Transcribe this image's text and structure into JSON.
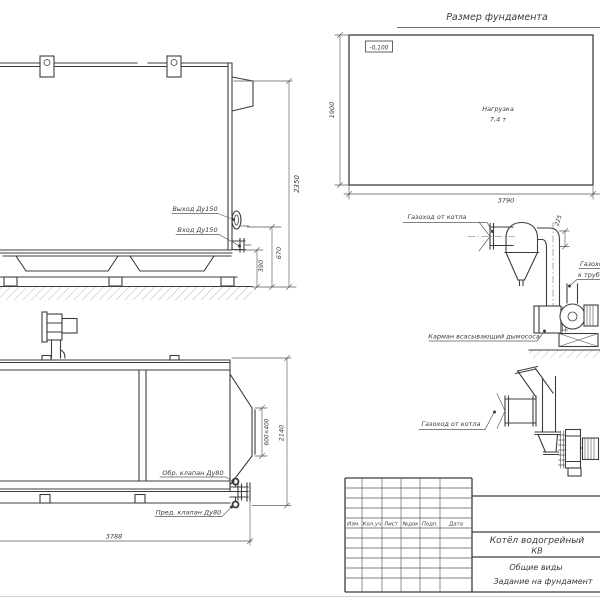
{
  "colors": {
    "line": "#3d3d3d",
    "thin_line": "#5a5a5a",
    "text": "#3a3a3a",
    "sheet": "#ffffff"
  },
  "side_view": {
    "label_outlet": "Выход Ду150",
    "label_inlet": "Вход Ду150",
    "dim_total_height": "2350",
    "dim_inlet_height": "670",
    "dim_frame_height": "390"
  },
  "foundation_plan": {
    "title": "Размер фундамента",
    "elevation_mark": "-0,100",
    "load_line1": "Нагрузка",
    "load_line2": "7,4 т",
    "dim_height": "1900",
    "dim_width": "3790"
  },
  "duct_elevation": {
    "label_from_boiler": "Газоход от котла",
    "dim_offset": "225",
    "label_to_stack_line1": "Газоход",
    "label_to_stack_line2": "к трубе",
    "label_suction_pocket": "Карман всасывающий дымососа"
  },
  "plan_view": {
    "label_check_valve": "Обр. клапан Ду80",
    "label_safety_valve": "Пред. клапан Ду80",
    "dim_flue_outlet": "600×400",
    "dim_width": "2140",
    "dim_length": "3788"
  },
  "duct_plan": {
    "label_from_boiler": "Газоход от котла"
  },
  "title_block": {
    "columns": [
      "Изм.",
      "Кол.уч",
      "Лист",
      "№док",
      "Подп.",
      "Дата"
    ],
    "doc_name_line1": "Котёл водогрейный",
    "doc_name_line2": "КВ",
    "doc_kind": "Общие виды",
    "doc_subject": "Задание на фундамент"
  }
}
